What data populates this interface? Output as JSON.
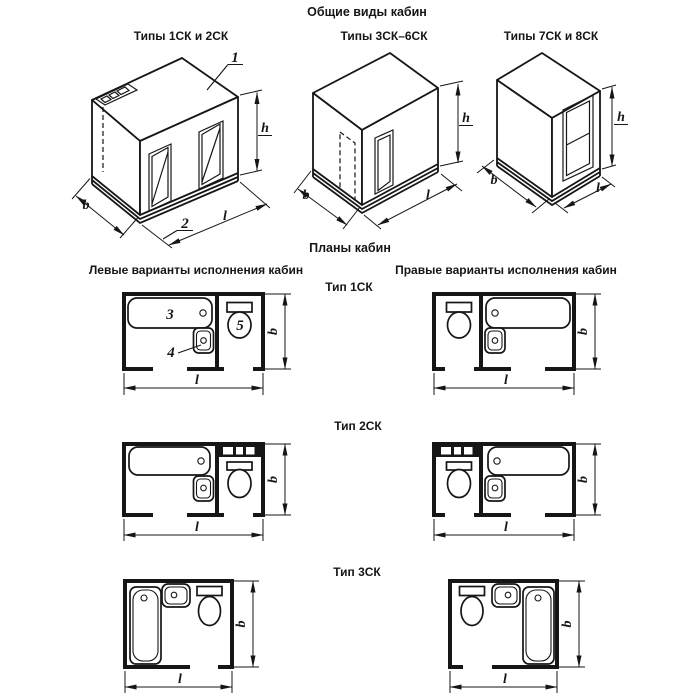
{
  "header": {
    "title": "Общие виды кабин"
  },
  "iso_section": {
    "views": [
      {
        "label": "Типы 1СК и 2СК"
      },
      {
        "label": "Типы 3СК–6СК"
      },
      {
        "label": "Типы 7СК и 8СК"
      }
    ],
    "callouts": {
      "ceiling_panel": "1",
      "floor_pallet": "2"
    }
  },
  "plans_section": {
    "title": "Планы кабин",
    "columns": {
      "left": "Левые варианты исполнения кабин",
      "right": "Правые варианты исполнения кабин"
    },
    "rows": [
      {
        "label": "Тип 1СК"
      },
      {
        "label": "Тип 2СК"
      },
      {
        "label": "Тип 3СК"
      }
    ],
    "callouts": {
      "bathtub": "3",
      "washbasin": "4",
      "toilet": "5"
    }
  },
  "dimensions": {
    "width": "b",
    "length": "l",
    "height": "h"
  },
  "colors": {
    "ink": "#161616",
    "background": "#ffffff"
  }
}
